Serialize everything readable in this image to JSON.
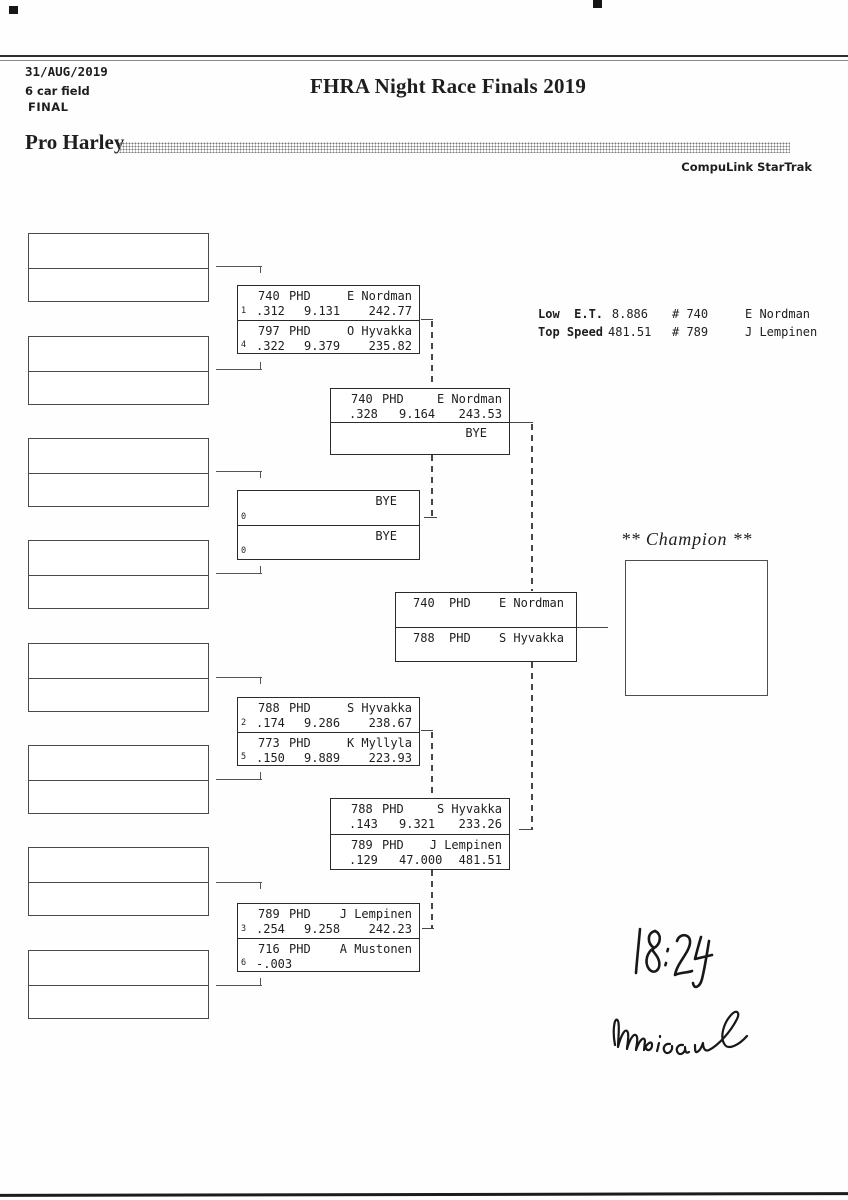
{
  "header": {
    "date": "31/AUG/2019",
    "field": "6 car field",
    "round": "FINAL",
    "title": "FHRA Night Race Finals 2019",
    "class_name": "Pro Harley",
    "system": "CompuLink StarTrak"
  },
  "stats": {
    "low_et_label": "Low  E.T.",
    "low_et_value": "8.886",
    "low_et_car": "# 740",
    "low_et_driver": "E Nordman",
    "top_speed_label": "Top Speed",
    "top_speed_value": "481.51",
    "top_speed_car": "# 789",
    "top_speed_driver": "J Lempinen"
  },
  "champion": {
    "label": "** Champion **"
  },
  "handwriting": {
    "time": "18:24",
    "signature": "Monica"
  },
  "bracket": {
    "box_a": {
      "entries": [
        {
          "seed": "1",
          "car": "740",
          "cls": "PHD",
          "driver": "E Nordman",
          "rt": ".312",
          "et": "9.131",
          "speed": "242.77"
        },
        {
          "seed": "4",
          "car": "797",
          "cls": "PHD",
          "driver": "O Hyvakka",
          "rt": ".322",
          "et": "9.379",
          "speed": "235.82"
        }
      ]
    },
    "semi_top": {
      "entries": [
        {
          "car": "740",
          "cls": "PHD",
          "driver": "E Nordman",
          "rt": ".328",
          "et": "9.164",
          "speed": "243.53"
        },
        {
          "bye": "BYE"
        }
      ]
    },
    "bye_box": {
      "entries": [
        {
          "bye": "BYE",
          "seed": "0"
        },
        {
          "bye": "BYE",
          "seed": "0"
        }
      ]
    },
    "final": {
      "entries": [
        {
          "car": "740",
          "cls": "PHD",
          "driver": "E Nordman"
        },
        {
          "car": "788",
          "cls": "PHD",
          "driver": "S Hyvakka"
        }
      ]
    },
    "box_b": {
      "entries": [
        {
          "seed": "2",
          "car": "788",
          "cls": "PHD",
          "driver": "S Hyvakka",
          "rt": ".174",
          "et": "9.286",
          "speed": "238.67"
        },
        {
          "seed": "5",
          "car": "773",
          "cls": "PHD",
          "driver": "K Myllyla",
          "rt": ".150",
          "et": "9.889",
          "speed": "223.93"
        }
      ]
    },
    "semi_bottom": {
      "entries": [
        {
          "car": "788",
          "cls": "PHD",
          "driver": "S Hyvakka",
          "rt": ".143",
          "et": "9.321",
          "speed": "233.26"
        },
        {
          "car": "789",
          "cls": "PHD",
          "driver": "J Lempinen",
          "rt": ".129",
          "et": "47.000",
          "speed": "481.51"
        }
      ]
    },
    "box_c": {
      "entries": [
        {
          "seed": "3",
          "car": "789",
          "cls": "PHD",
          "driver": "J Lempinen",
          "rt": ".254",
          "et": "9.258",
          "speed": "242.23"
        },
        {
          "seed": "6",
          "car": "716",
          "cls": "PHD",
          "driver": "A Mustonen",
          "rt": "-.003"
        }
      ]
    }
  }
}
